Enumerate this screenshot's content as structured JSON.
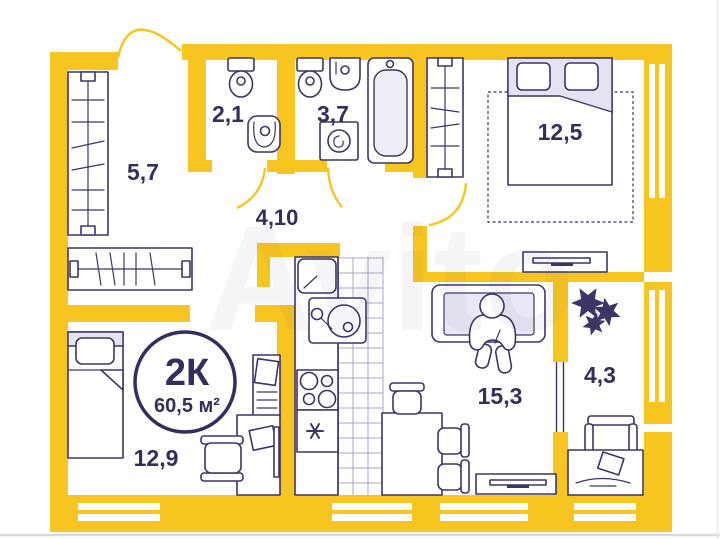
{
  "watermark": {
    "text": "Avito"
  },
  "badge": {
    "type": "2К",
    "area": "60,5 м²"
  },
  "rooms": {
    "wardrobe": {
      "area": "5,7"
    },
    "wc": {
      "area": "2,1"
    },
    "bath": {
      "area": "3,7"
    },
    "hall": {
      "area": "4,10"
    },
    "bedroom": {
      "area": "12,5"
    },
    "kids": {
      "area": "12,9"
    },
    "living": {
      "area": "15,3"
    },
    "balcony": {
      "area": "4,3"
    }
  },
  "colors": {
    "wall_yellow": "#F7C51F",
    "line_navy": "#3D3566",
    "light_lavender": "#E4E3F1",
    "text_navy": "#352D5B"
  }
}
